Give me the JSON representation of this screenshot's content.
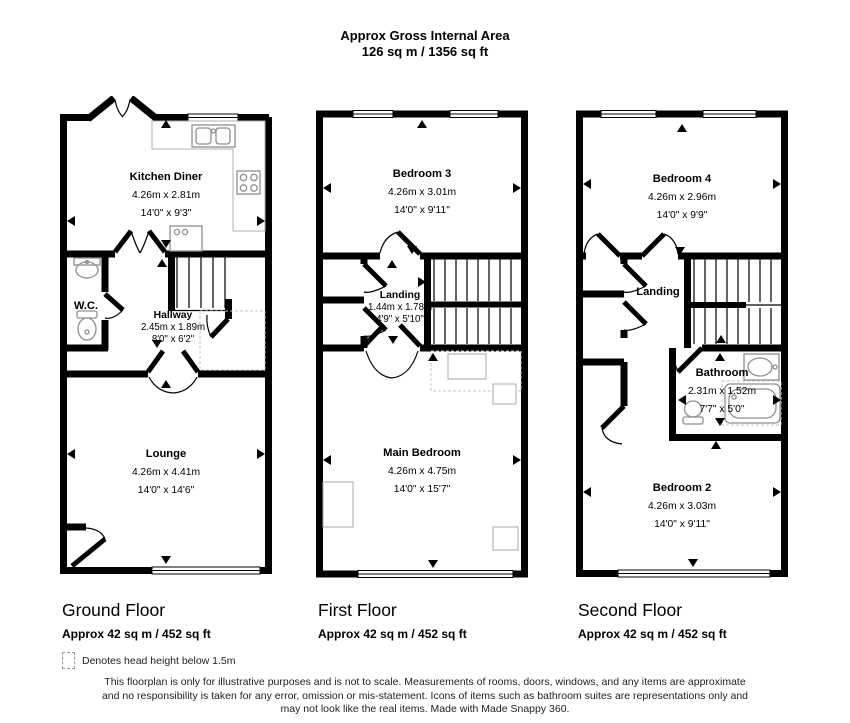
{
  "header": {
    "title": "Approx Gross Internal Area",
    "subtitle": "126 sq m / 1356 sq ft"
  },
  "floors": [
    {
      "name": "Ground Floor",
      "area": "Approx 42 sq m / 452 sq ft",
      "rooms": [
        {
          "name": "Kitchen Diner",
          "metric": "4.26m x 2.81m",
          "imperial": "14'0\" x 9'3\""
        },
        {
          "name": "W.C.",
          "metric": "",
          "imperial": ""
        },
        {
          "name": "Hallway",
          "metric": "2.45m x 1.89m",
          "imperial": "8'0\" x 6'2\""
        },
        {
          "name": "Lounge",
          "metric": "4.26m x 4.41m",
          "imperial": "14'0\" x 14'6\""
        }
      ]
    },
    {
      "name": "First Floor",
      "area": "Approx 42 sq m / 452 sq ft",
      "rooms": [
        {
          "name": "Bedroom 3",
          "metric": "4.26m x 3.01m",
          "imperial": "14'0\" x 9'11\""
        },
        {
          "name": "Landing",
          "metric": "1.44m x 1.78m",
          "imperial": "4'9\" x 5'10\""
        },
        {
          "name": "Main Bedroom",
          "metric": "4.26m x 4.75m",
          "imperial": "14'0\" x 15'7\""
        }
      ]
    },
    {
      "name": "Second Floor",
      "area": "Approx 42 sq m / 452 sq ft",
      "rooms": [
        {
          "name": "Bedroom 4",
          "metric": "4.26m x 2.96m",
          "imperial": "14'0\" x 9'9\""
        },
        {
          "name": "Landing",
          "metric": "",
          "imperial": ""
        },
        {
          "name": "Bathroom",
          "metric": "2.31m x 1.52m",
          "imperial": "7'7\" x 5'0\""
        },
        {
          "name": "Bedroom 2",
          "metric": "4.26m x 3.03m",
          "imperial": "14'0\" x 9'11\""
        }
      ]
    }
  ],
  "legend": {
    "text": "Denotes head height below 1.5m"
  },
  "disclaimer": {
    "line1": "This floorplan is only for illustrative purposes and is not to scale. Measurements of rooms, doors, windows, and any items are approximate",
    "line2": "and no responsibility is taken for any error, omission or mis-statement. Icons of items such as bathroom suites are representations only and",
    "line3": "may not look like the real items. Made with Made Snappy 360."
  },
  "colors": {
    "wall": "#000000",
    "fixture": "#8f8f8f",
    "counter": "#b0b0b0",
    "dashed_zone": "#c4c4c4"
  }
}
